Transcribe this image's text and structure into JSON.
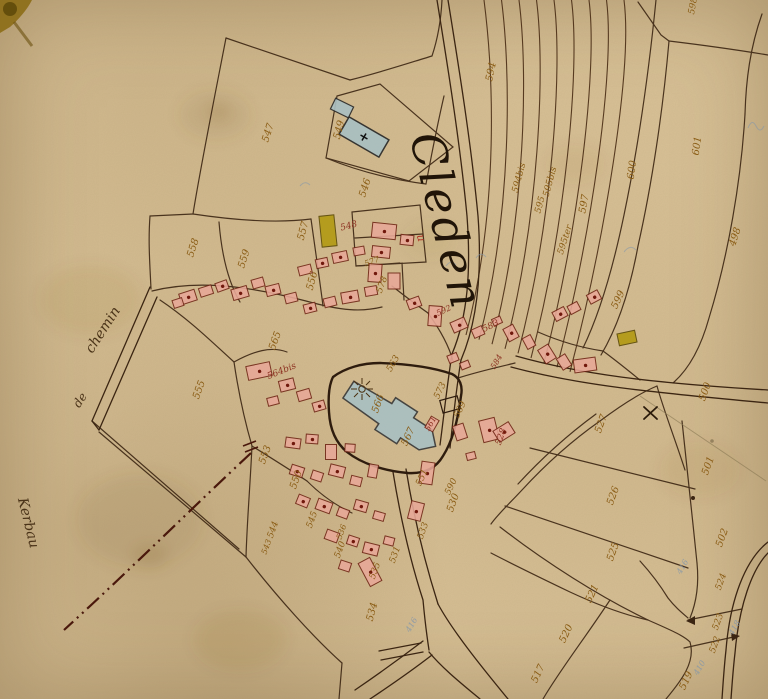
{
  "map": {
    "title": "Cleden",
    "title_mark": "u",
    "road_labels": [
      {
        "t": "chemin",
        "x": 103,
        "y": 330,
        "r": -57,
        "s": 14
      },
      {
        "t": "de",
        "x": 80,
        "y": 400,
        "r": -57,
        "s": 12
      },
      {
        "t": "Kerbau",
        "x": 28,
        "y": 523,
        "r": 76,
        "s": 14
      }
    ],
    "parcel_labels": [
      {
        "t": "594",
        "x": 492,
        "y": 72,
        "r": -78
      },
      {
        "t": "594bis",
        "x": 520,
        "y": 178,
        "r": -75,
        "s": 9
      },
      {
        "t": "595bis",
        "x": 551,
        "y": 182,
        "r": -75,
        "s": 9
      },
      {
        "t": "595",
        "x": 541,
        "y": 205,
        "r": -75,
        "s": 9
      },
      {
        "t": "595ter",
        "x": 566,
        "y": 240,
        "r": -72,
        "s": 9
      },
      {
        "t": "597",
        "x": 585,
        "y": 204,
        "r": -80
      },
      {
        "t": "600",
        "x": 633,
        "y": 170,
        "r": -82
      },
      {
        "t": "601",
        "x": 698,
        "y": 146,
        "r": -82
      },
      {
        "t": "498",
        "x": 736,
        "y": 237,
        "r": -72
      },
      {
        "t": "598",
        "x": 694,
        "y": 6,
        "r": -80,
        "s": 9
      },
      {
        "t": "599",
        "x": 619,
        "y": 300,
        "r": -65
      },
      {
        "t": "558",
        "x": 194,
        "y": 248,
        "r": -72
      },
      {
        "t": "559",
        "x": 245,
        "y": 259,
        "r": -72
      },
      {
        "t": "557",
        "x": 304,
        "y": 231,
        "r": -75
      },
      {
        "t": "556",
        "x": 313,
        "y": 281,
        "r": -75
      },
      {
        "t": "555",
        "x": 200,
        "y": 390,
        "r": -70
      },
      {
        "t": "553",
        "x": 266,
        "y": 455,
        "r": -70
      },
      {
        "t": "547",
        "x": 269,
        "y": 133,
        "r": -72
      },
      {
        "t": "549",
        "x": 340,
        "y": 130,
        "r": -75
      },
      {
        "t": "546",
        "x": 366,
        "y": 188,
        "r": -72
      },
      {
        "t": "548",
        "x": 349,
        "y": 227,
        "r": -15,
        "c": "red",
        "s": 9
      },
      {
        "t": "577",
        "x": 372,
        "y": 262,
        "r": -20,
        "s": 8
      },
      {
        "t": "578",
        "x": 383,
        "y": 285,
        "r": -70,
        "s": 9
      },
      {
        "t": "565",
        "x": 276,
        "y": 341,
        "r": -70
      },
      {
        "t": "564bis",
        "x": 282,
        "y": 372,
        "r": -22,
        "c": "red",
        "s": 9
      },
      {
        "t": "566",
        "x": 379,
        "y": 404,
        "r": -70
      },
      {
        "t": "567",
        "x": 409,
        "y": 437,
        "r": -65
      },
      {
        "t": "561",
        "x": 431,
        "y": 424,
        "r": -62,
        "c": "red",
        "s": 8
      },
      {
        "t": "573",
        "x": 441,
        "y": 391,
        "r": -65,
        "s": 9
      },
      {
        "t": "569",
        "x": 461,
        "y": 410,
        "r": -65,
        "s": 9
      },
      {
        "t": "563",
        "x": 394,
        "y": 364,
        "r": -60,
        "s": 9
      },
      {
        "t": "592",
        "x": 444,
        "y": 311,
        "r": -25,
        "c": "red",
        "s": 8
      },
      {
        "t": "583",
        "x": 491,
        "y": 327,
        "r": -25,
        "c": "red",
        "s": 9
      },
      {
        "t": "584",
        "x": 497,
        "y": 362,
        "r": -60,
        "c": "red",
        "s": 8
      },
      {
        "t": "550",
        "x": 297,
        "y": 480,
        "r": -70
      },
      {
        "t": "545",
        "x": 313,
        "y": 520,
        "r": -70,
        "s": 9
      },
      {
        "t": "544",
        "x": 274,
        "y": 530,
        "r": -70,
        "s": 9
      },
      {
        "t": "543",
        "x": 267,
        "y": 547,
        "r": -70,
        "s": 8
      },
      {
        "t": "540",
        "x": 341,
        "y": 550,
        "r": -70,
        "s": 9
      },
      {
        "t": "536",
        "x": 342,
        "y": 532,
        "r": -70,
        "s": 8
      },
      {
        "t": "535",
        "x": 376,
        "y": 571,
        "r": -70,
        "s": 9
      },
      {
        "t": "534",
        "x": 373,
        "y": 612,
        "r": -75
      },
      {
        "t": "531",
        "x": 396,
        "y": 555,
        "r": -70,
        "s": 9
      },
      {
        "t": "533",
        "x": 424,
        "y": 531,
        "r": -70,
        "s": 9
      },
      {
        "t": "530",
        "x": 454,
        "y": 503,
        "r": -70
      },
      {
        "t": "551",
        "x": 423,
        "y": 478,
        "r": -65,
        "s": 9
      },
      {
        "t": "590",
        "x": 452,
        "y": 487,
        "r": -65,
        "s": 9
      },
      {
        "t": "528",
        "x": 502,
        "y": 437,
        "r": -70,
        "c": "red",
        "s": 9
      },
      {
        "t": "527",
        "x": 602,
        "y": 424,
        "r": -70
      },
      {
        "t": "526",
        "x": 614,
        "y": 496,
        "r": -70
      },
      {
        "t": "525",
        "x": 614,
        "y": 552,
        "r": -70
      },
      {
        "t": "500",
        "x": 706,
        "y": 392,
        "r": -70
      },
      {
        "t": "501",
        "x": 709,
        "y": 466,
        "r": -70
      },
      {
        "t": "502",
        "x": 723,
        "y": 538,
        "r": -70
      },
      {
        "t": "521",
        "x": 593,
        "y": 594,
        "r": -65
      },
      {
        "t": "520",
        "x": 567,
        "y": 634,
        "r": -65
      },
      {
        "t": "524",
        "x": 722,
        "y": 582,
        "r": -70,
        "s": 9
      },
      {
        "t": "523",
        "x": 719,
        "y": 622,
        "r": -70,
        "s": 9
      },
      {
        "t": "522",
        "x": 716,
        "y": 645,
        "r": -70,
        "s": 9
      },
      {
        "t": "519",
        "x": 687,
        "y": 681,
        "r": -65
      },
      {
        "t": "517",
        "x": 539,
        "y": 674,
        "r": -65
      }
    ],
    "pencil_labels": [
      {
        "t": "416",
        "x": 683,
        "y": 567,
        "r": -60
      },
      {
        "t": "416",
        "x": 412,
        "y": 625,
        "r": -60
      },
      {
        "t": "418",
        "x": 735,
        "y": 628,
        "r": -60
      },
      {
        "t": "410",
        "x": 700,
        "y": 668,
        "r": -60
      }
    ],
    "colors": {
      "parchment": "#d7c096",
      "ink": "#3b2512",
      "building_fill": "#e8a898",
      "building_stroke": "#6e2414",
      "church_fill": "#a9bfc2",
      "yellow_building": "#b29a12",
      "label_ochre": "#8a5c14",
      "label_red": "#8c3020",
      "pencil_blue": "#7f95ad"
    }
  }
}
